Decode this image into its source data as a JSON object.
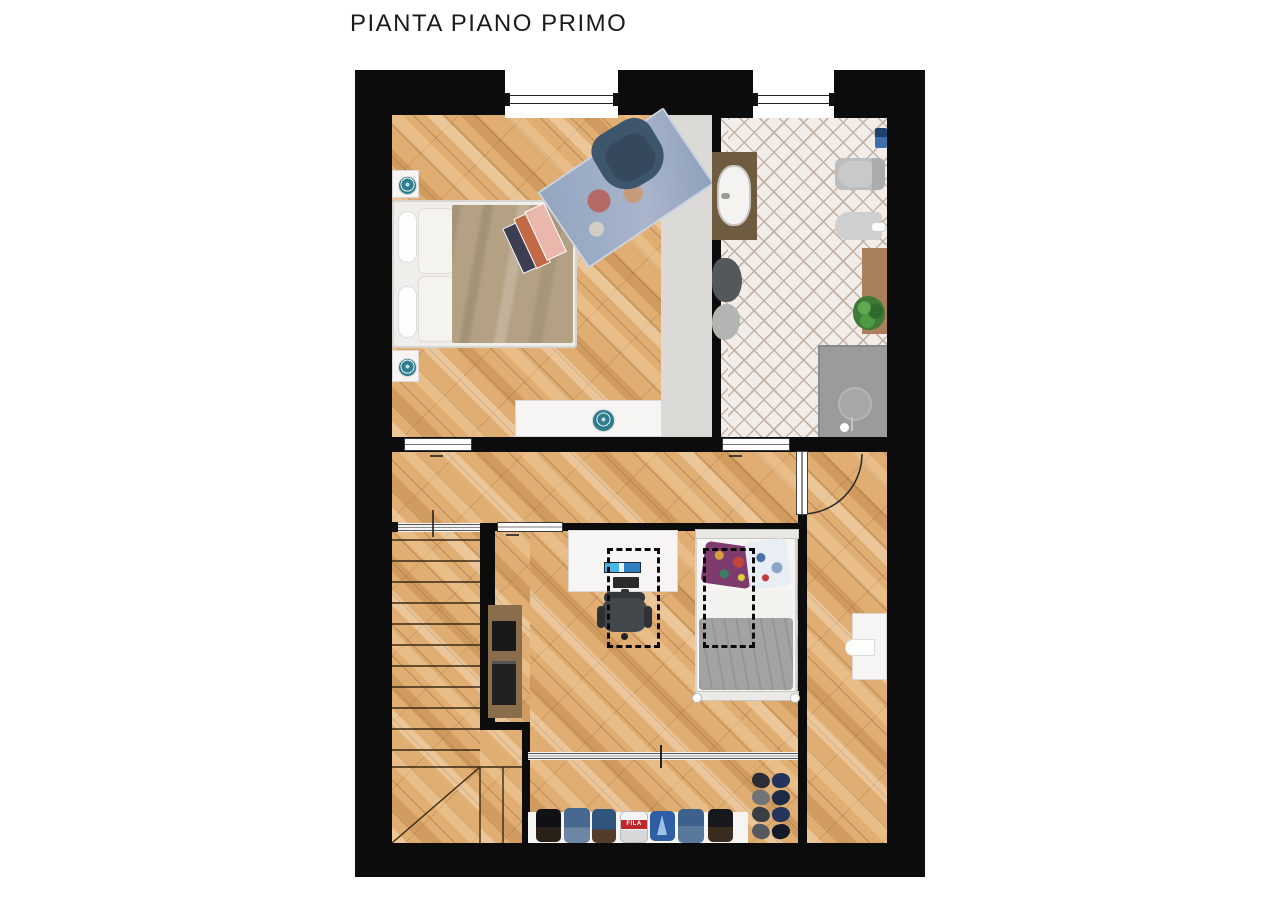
{
  "title": "PIANTA PIANO PRIMO",
  "palette": {
    "wall": "#0c0c0c",
    "paper": "#ffffff",
    "wood_base": "#e0ad72",
    "tile_base": "#f2ede8",
    "tile_line": "#c2b2a8",
    "gray_area": "#dcdad6",
    "teal_plate": "#2e7d8f",
    "duvet_khaki": "#b4a183",
    "armchair_blue": "#3e566b",
    "shower_gray": "#9b9b9b",
    "vanity_brown": "#6f5b40",
    "mat_brown": "#a97f5c",
    "plant_green": "#3f7a36",
    "duvet_gray": "#a3a3a3",
    "cabinet_brown": "#8a6e4b",
    "box_red": "#c0272d",
    "denim_blue": "#47688f"
  },
  "rooms": [
    {
      "key": "bedroom-1",
      "floor": "diagonal-parquet"
    },
    {
      "key": "bathroom",
      "floor": "herringbone-tile"
    },
    {
      "key": "hallway-landing",
      "floor": "diagonal-parquet"
    },
    {
      "key": "staircase",
      "floor": "diagonal-parquet"
    },
    {
      "key": "bedroom-2",
      "floor": "diagonal-parquet"
    },
    {
      "key": "side-room",
      "floor": "diagonal-parquet"
    }
  ],
  "furniture": {
    "bedroom_1": [
      "double-bed",
      "nightstand-top",
      "nightstand-bottom",
      "decor-plate",
      "area-rug",
      "armchair",
      "low-dresser",
      "books"
    ],
    "bathroom": [
      "vanity-with-sink",
      "toilet",
      "bidet",
      "towels",
      "bath-mat",
      "plant",
      "shower"
    ],
    "bedroom_2": [
      "desk-with-computer",
      "office-chair",
      "single-bed",
      "media-cabinet",
      "skylight-marking-1",
      "skylight-marking-2",
      "wardrobe-rail",
      "clothes-shelf",
      "shoe-rack"
    ],
    "side_room": [
      "radiator"
    ]
  },
  "wardrobe": {
    "box_label": "FILA"
  }
}
